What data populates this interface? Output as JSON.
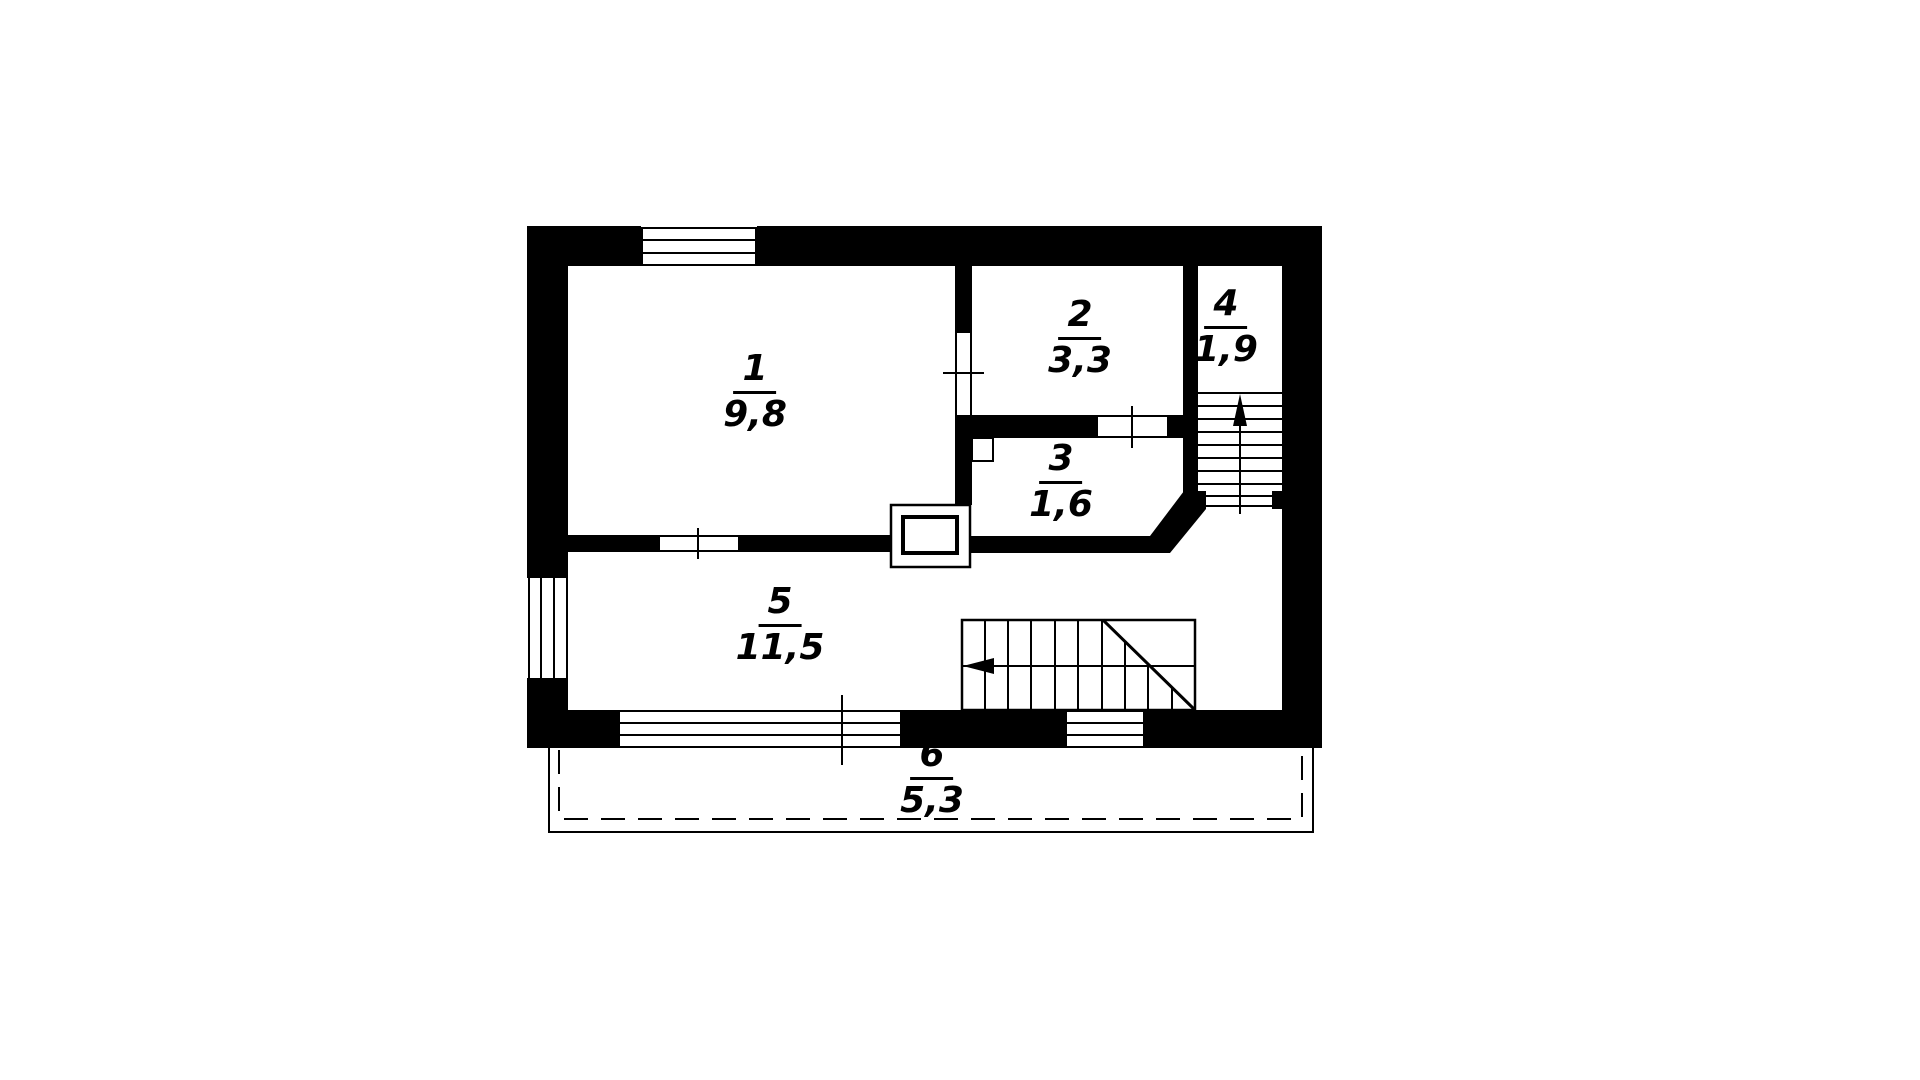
{
  "drawing": {
    "type": "floor-plan",
    "units_hint": "area values in square meters, decimal comma notation"
  },
  "colors": {
    "wall": "#000000",
    "background": "#ffffff",
    "line": "#000000"
  },
  "rooms": [
    {
      "id": "room-1",
      "number": "1",
      "area": "9,8"
    },
    {
      "id": "room-2",
      "number": "2",
      "area": "3,3"
    },
    {
      "id": "room-3",
      "number": "3",
      "area": "1,6"
    },
    {
      "id": "room-4",
      "number": "4",
      "area": "1,9"
    },
    {
      "id": "room-5",
      "number": "5",
      "area": "11,5"
    },
    {
      "id": "room-6",
      "number": "6",
      "area": "5,3"
    }
  ],
  "features": {
    "stair_main": "straight flight with break line, walk line arrow pointing left",
    "stair_room4": "flight up with arrow pointing up",
    "porch": "dashed outline below bottom wall (room 6)",
    "chimney": "flue block between rooms 1, 3 and 5",
    "windows": "top wall, left wall, two in bottom wall",
    "doors": "room1-room2, room2-room3, room1-room5 opening, room4 threshold"
  }
}
